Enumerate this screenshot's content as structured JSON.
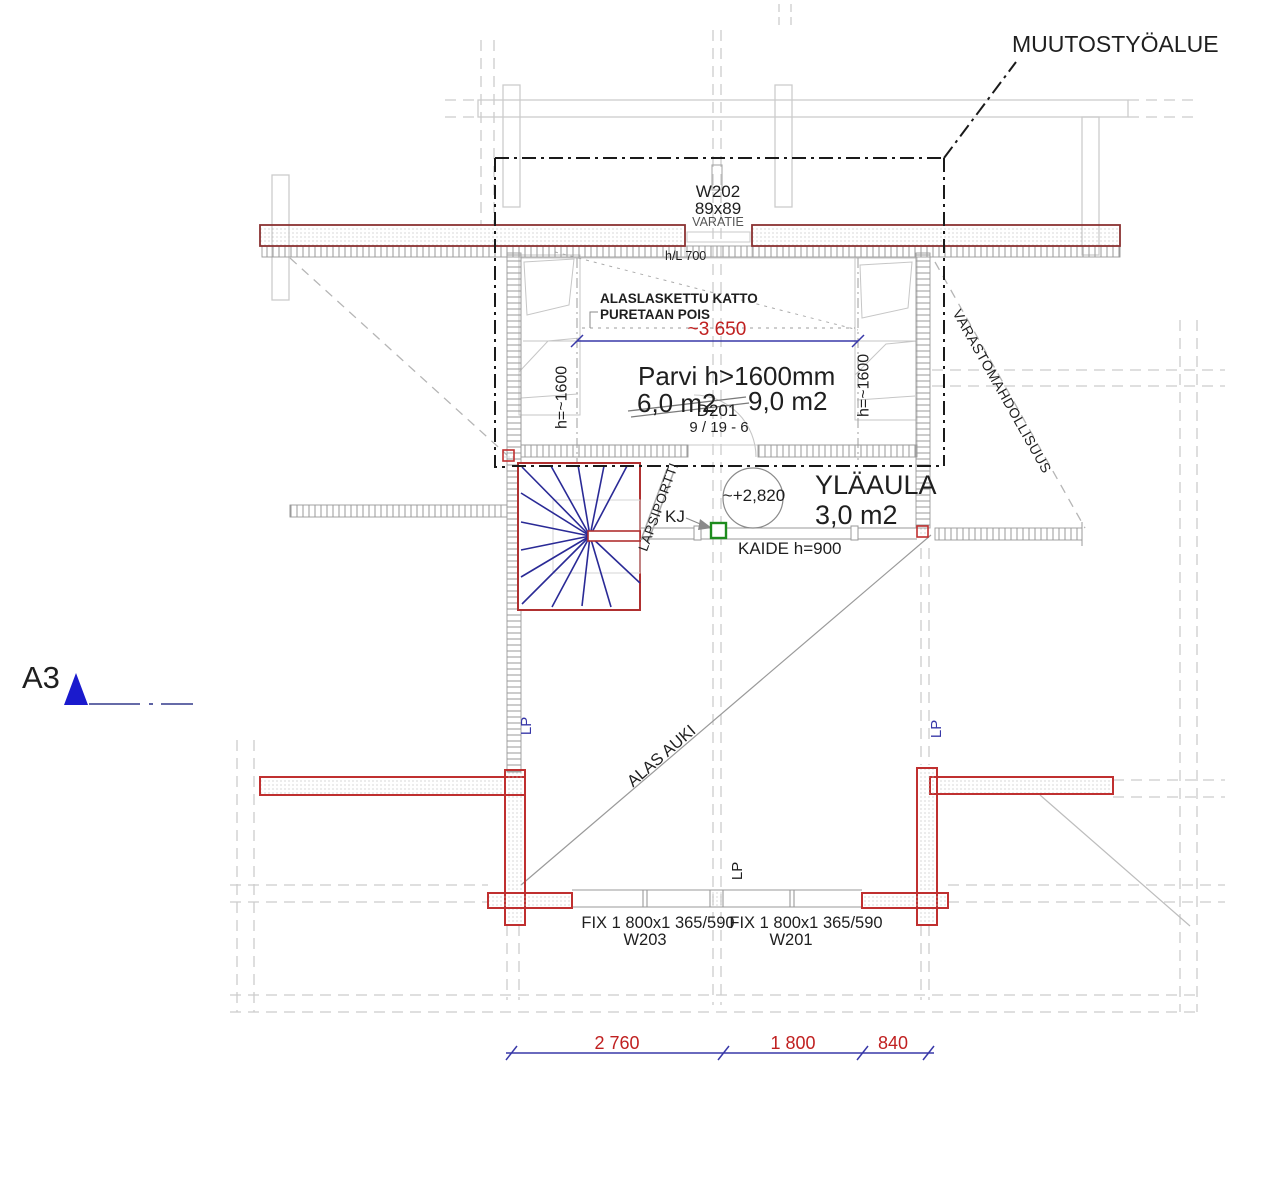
{
  "drawing": {
    "annotation_area": "MUUTOSTYÖALUE",
    "window_top": {
      "code": "W202",
      "size": "89x89",
      "note": "VARATIE"
    },
    "hl_note": "h/L 700",
    "ceiling_note_line1": "ALASLASKETTU KATTO",
    "ceiling_note_line2": "PURETAAN POIS",
    "dim_width": "~3 650",
    "height_left": "h=~1600",
    "height_right": "h=~1600",
    "loft_title": "Parvi h>1600mm",
    "loft_area_old": "6,0 m2",
    "loft_area_new": "9,0 m2",
    "door_code": "D201",
    "door_ref": "9 / 19 - 6",
    "level_mark": "~+2,820",
    "hall_name": "YLÄAULA",
    "hall_area": "3,0 m2",
    "kj_label": "KJ",
    "railing_note": "KAIDE h=900",
    "gate_note": "LAPSIPORTTI",
    "storage_note": "VARASTOMAHDOLLISUUS",
    "open_below_note": "ALAS AUKI",
    "lp_left": "LP",
    "lp_right": "LP",
    "lp_bottom": "LP",
    "sheet_size": "A3",
    "window_left": {
      "spec": "FIX 1 800x1 365/590",
      "code": "W203"
    },
    "window_right": {
      "spec": "FIX 1 800x1 365/590",
      "code": "W201"
    },
    "dims_bottom": {
      "d1": "2 760",
      "d2": "1 800",
      "d3": "840"
    },
    "colors": {
      "beam_red": "#c03030",
      "beam_dark_red": "#8b3232",
      "dim_blue": "#3838a8",
      "dim_text_red": "#c02020",
      "stair_blue": "#2a2a96",
      "gate_green": "#1e8c1e",
      "triangle_blue": "#1a1acd",
      "structure_gray": "#c9c9c9"
    }
  }
}
